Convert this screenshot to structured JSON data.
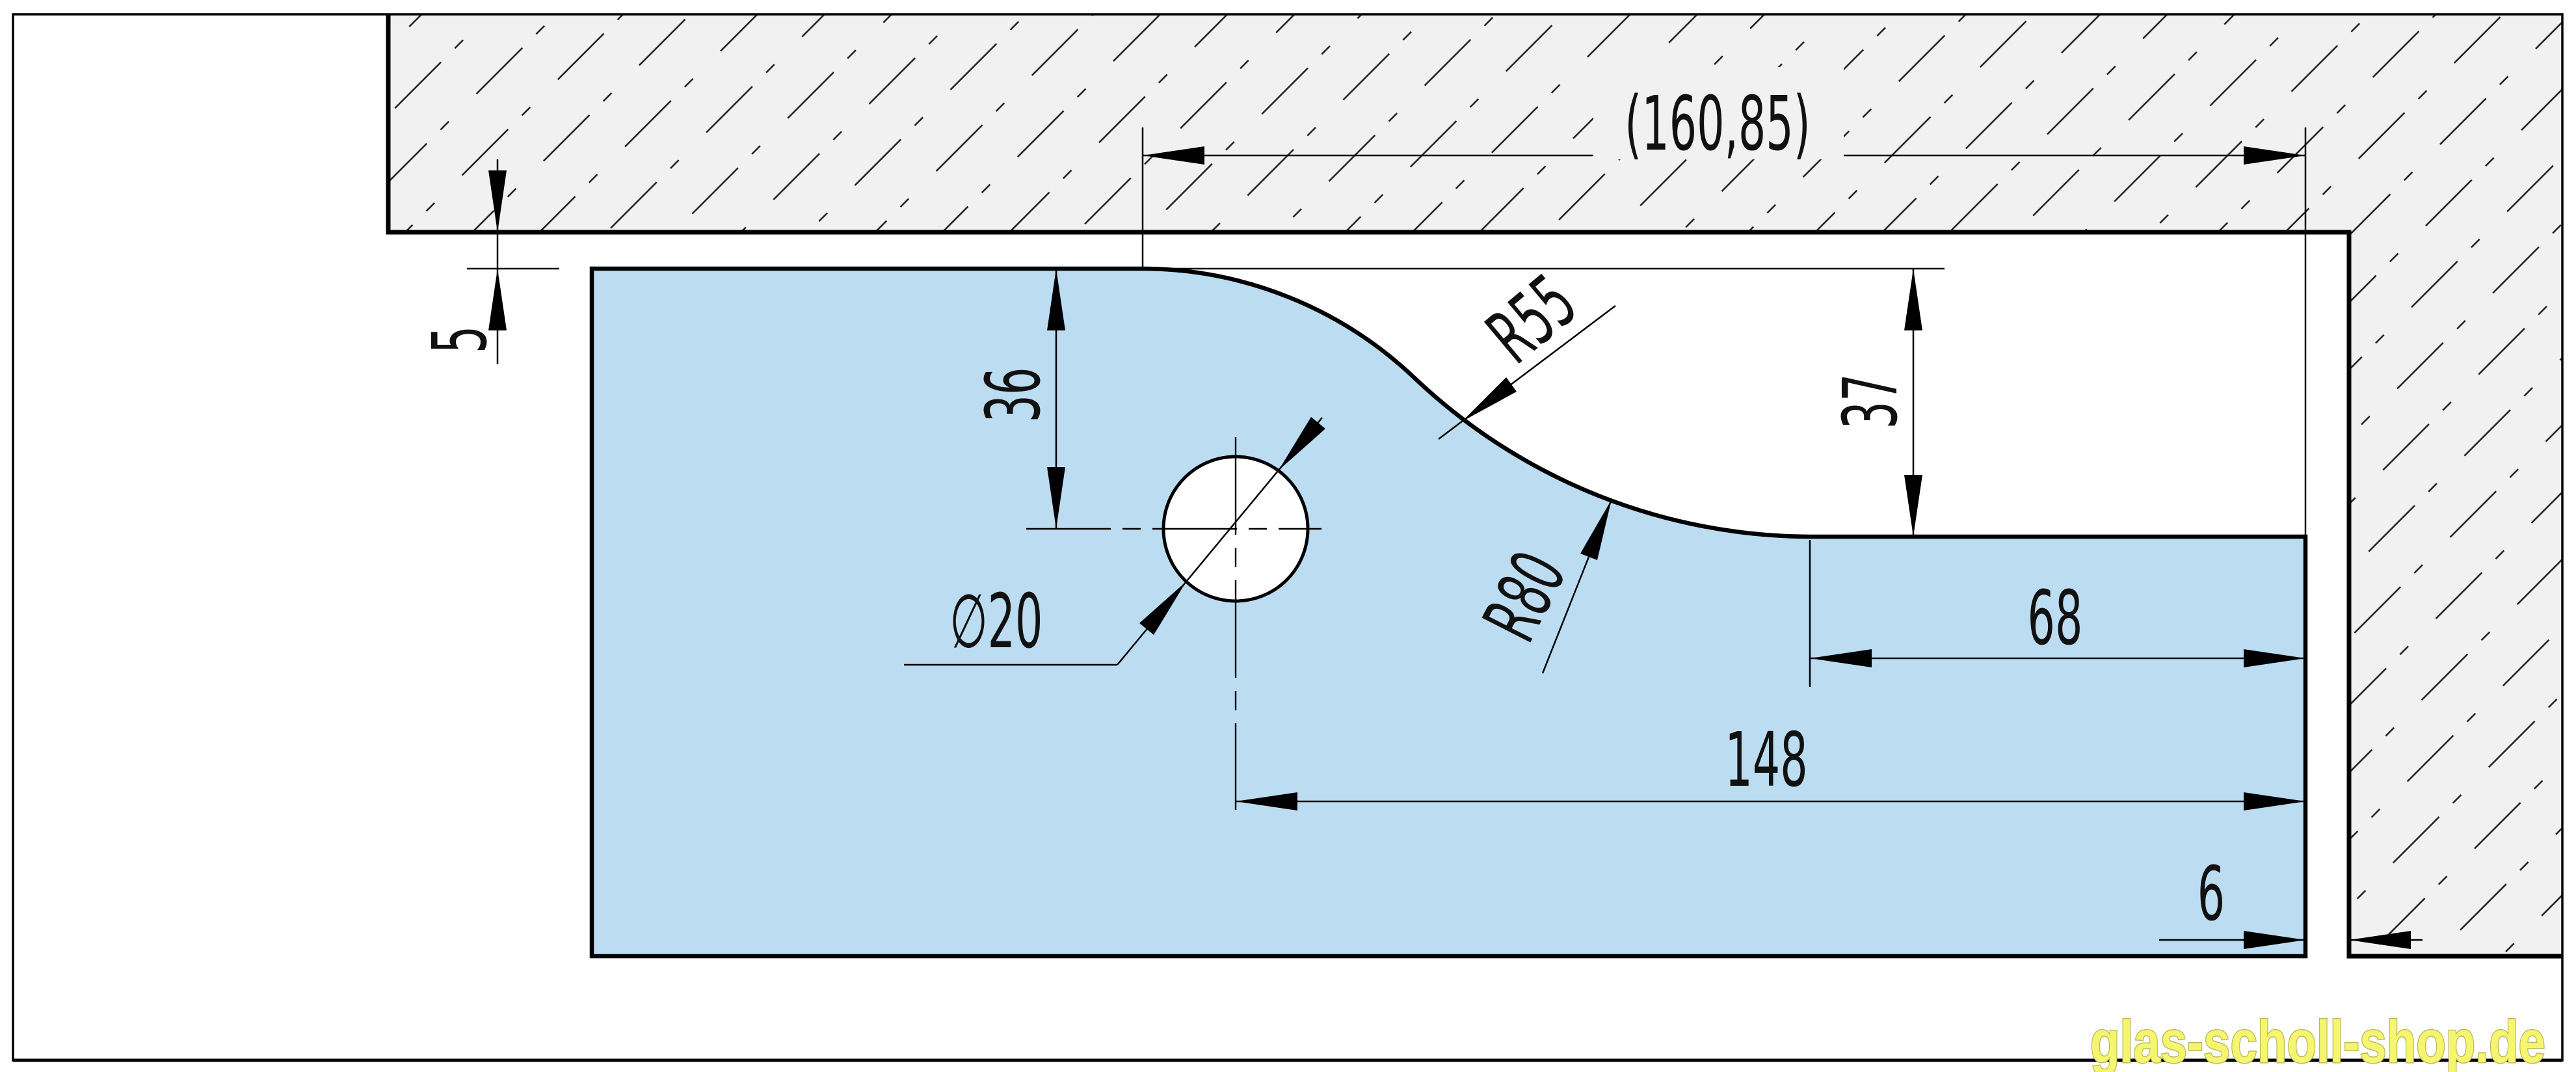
{
  "drawing": {
    "type": "glass-panel-cutout-technical-drawing",
    "dimensions": {
      "overall_width": "(160,85)",
      "top_gap": "5",
      "hole_center_from_top": "36",
      "cutout_depth": "37",
      "upper_radius": "R55",
      "lower_radius": "R80",
      "hole_diameter": "∅20",
      "shelf_width": "68",
      "hole_center_to_right_edge": "148",
      "right_gap": "6"
    },
    "colors": {
      "glass": "#bcdcf2",
      "wall_fill": "#f1f1f1",
      "hatch_line": "#1c1c1c",
      "line": "#000000",
      "watermark_fill": "#f6f570",
      "watermark_outline": "#b9b95a"
    }
  },
  "watermark": {
    "text": "glas-scholl-shop.de"
  }
}
